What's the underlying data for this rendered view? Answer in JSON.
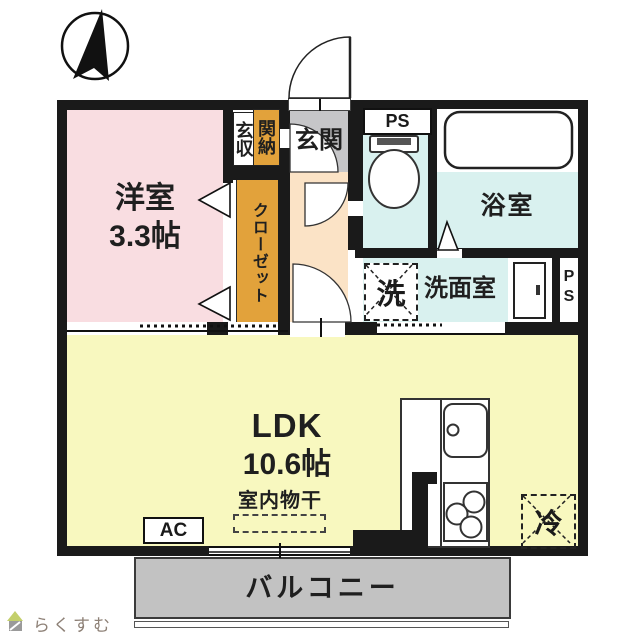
{
  "colors": {
    "wall": "#1a1a1a",
    "yoshitsu": "#f9dde1",
    "closet": "#e2a23b",
    "hall": "#fbe3c6",
    "genkan": "#c6c6c8",
    "wet": "#d9f1ef",
    "ldk": "#f8f8bf",
    "balcony": "#c2c2c2",
    "logo-text": "#8d8076",
    "logo-roof": "#c3cf6b",
    "logo-body": "#9a9a9a"
  },
  "rooms": {
    "yoshitsu": {
      "name": "洋室",
      "size": "3.3帖"
    },
    "closet": {
      "label": "クローゼット"
    },
    "genkan_storage": {
      "left_column": "玄収",
      "right_column": "関納"
    },
    "genkan": {
      "label": "玄関"
    },
    "ps_top": {
      "label": "PS"
    },
    "bath": {
      "label": "浴室"
    },
    "washroom": {
      "label": "洗面室"
    },
    "washer": {
      "label": "洗"
    },
    "ps_right": {
      "line1": "P",
      "line2": "S"
    },
    "ldk": {
      "name": "LDK",
      "size": "10.6帖",
      "note": "室内物干"
    },
    "ac": {
      "label": "AC"
    },
    "fridge": {
      "label": "冷"
    },
    "balcony": {
      "label": "バルコニー"
    }
  },
  "footer": {
    "logo_text": "らくすむ"
  }
}
